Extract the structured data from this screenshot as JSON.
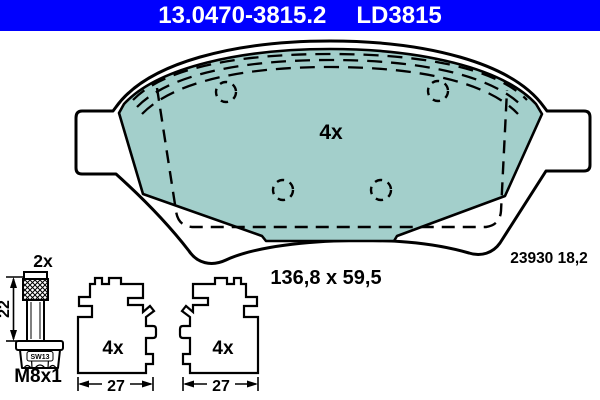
{
  "header": {
    "part_number": "13.0470-3815.2",
    "variant_code": "LD3815",
    "background_color": "#0000fe",
    "text_color": "#ffffff"
  },
  "main_drawing": {
    "quantity_label": "4x",
    "dimensions_label": "136,8 x 59,5",
    "wva_thickness_label": "23930 18,2",
    "pad_fill_color": "#a3cfcb",
    "line_color": "#000000"
  },
  "bolt_drawing": {
    "quantity_label": "2x",
    "length_dimension": "22",
    "wrench_size_label": "SW13",
    "thread_label": "M8x1"
  },
  "clip_drawings": [
    {
      "quantity_label": "4x",
      "width_dimension": "27"
    },
    {
      "quantity_label": "4x",
      "width_dimension": "27"
    }
  ]
}
